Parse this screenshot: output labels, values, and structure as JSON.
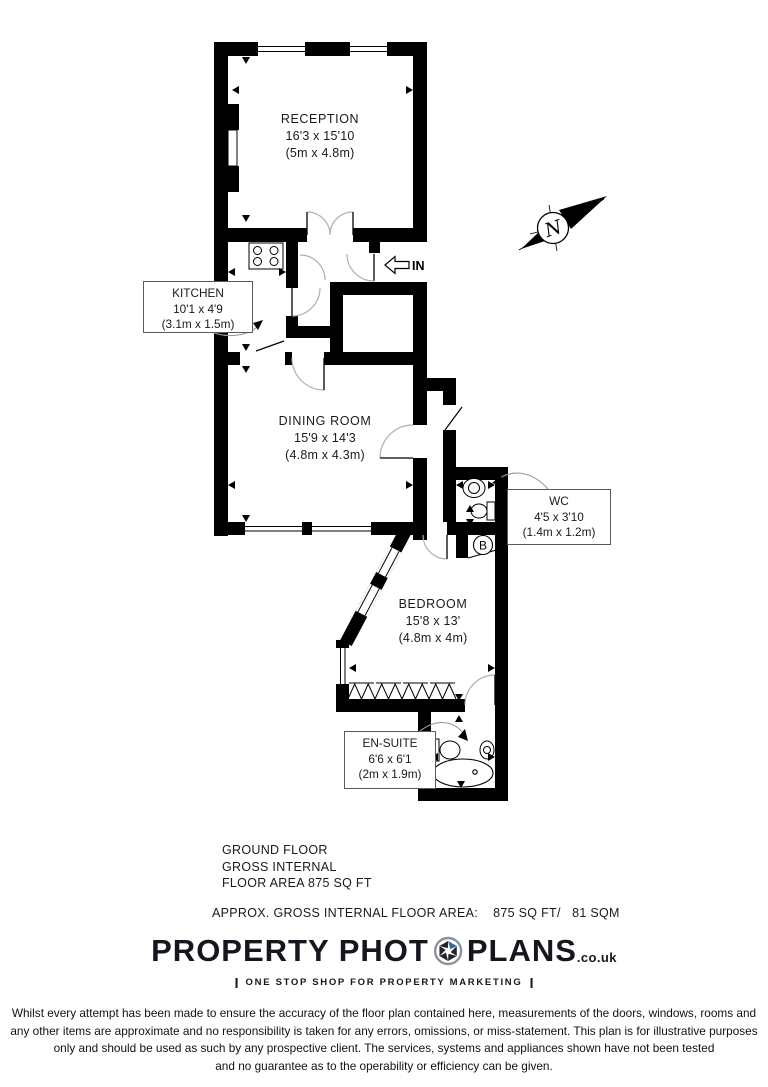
{
  "floor_plan": {
    "rooms": [
      {
        "name": "RECEPTION",
        "size_imperial": "16'3 x 15'10",
        "size_metric": "(5m x 4.8m)"
      },
      {
        "name": "KITCHEN",
        "size_imperial": "10'1 x 4'9",
        "size_metric": "(3.1m x 1.5m)"
      },
      {
        "name": "DINING ROOM",
        "size_imperial": "15'9 x 14'3",
        "size_metric": "(4.8m x 4.3m)"
      },
      {
        "name": "WC",
        "size_imperial": "4'5 x 3'10",
        "size_metric": "(1.4m x 1.2m)"
      },
      {
        "name": "BEDROOM",
        "size_imperial": "15'8 x 13'",
        "size_metric": "(4.8m x 4m)"
      },
      {
        "name": "EN-SUITE",
        "size_imperial": "6'6 x 6'1",
        "size_metric": "(2m x 1.9m)"
      }
    ],
    "entrance_label": "IN",
    "boiler_label": "B",
    "compass_north_label": "N",
    "wall_color": "#000000",
    "door_arc_color": "#b0b0b0"
  },
  "summary": {
    "line1": "GROUND FLOOR",
    "line2": "GROSS INTERNAL",
    "line3": "FLOOR AREA 875 SQ FT",
    "approx_area_line": "APPROX. GROSS INTERNAL FLOOR AREA:    875 SQ FT/   81 SQM"
  },
  "branding": {
    "name_part1": "PROPERTY PHOT",
    "name_part2": "PLANS",
    "domain_suffix": ".co.uk",
    "tagline": "ONE STOP SHOP FOR PROPERTY MARKETING",
    "logo_text_color": "#16161e",
    "aperture_blue": "#2e6da4"
  },
  "disclaimer": {
    "line1": "Whilst every attempt has been made to ensure the accuracy of the floor plan contained here, measurements of the doors, windows, rooms and",
    "line2": "any other items are approximate and no responsibility is taken for any errors, omissions, or miss-statement. This plan is for illustrative purposes",
    "line3": "only and should be used as such by any prospective client. The services, systems and appliances shown have not been tested",
    "line4": "and no guarantee as to the operability or efficiency can be given."
  }
}
